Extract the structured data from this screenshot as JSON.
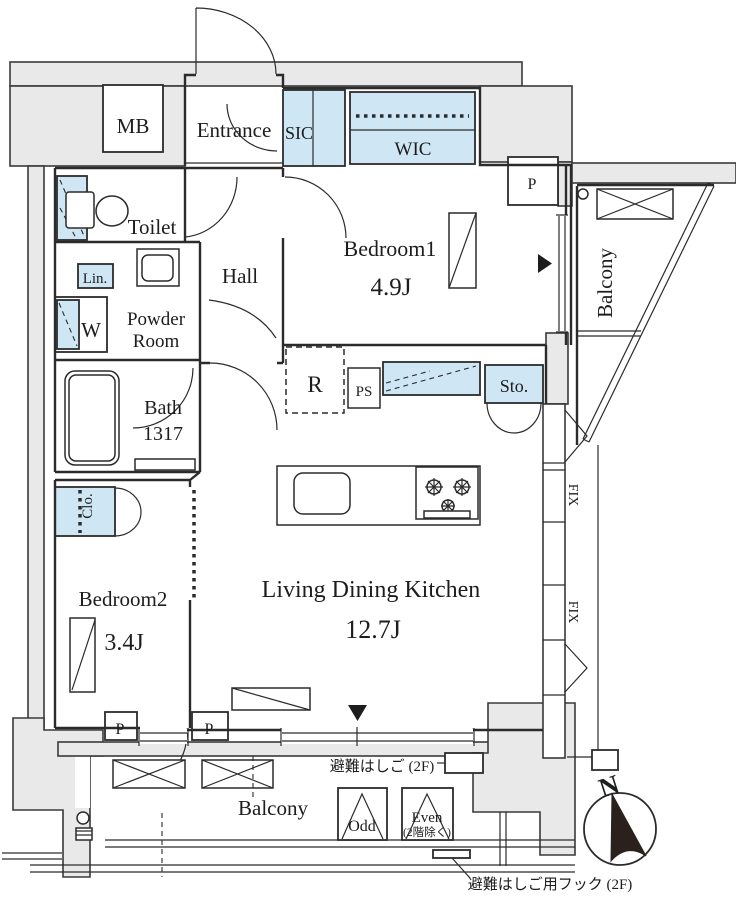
{
  "title": "apartment-floor-plan",
  "colors": {
    "fixture_blue": "#cfe7f5",
    "structure_gray": "#e9e9e9",
    "line": "#2b2b2b",
    "text": "#1d1d1d",
    "compass_black": "#2a211c"
  },
  "rooms": {
    "mb": "MB",
    "entrance": "Entrance",
    "sic": "SIC",
    "wic": "WIC",
    "toilet": "Toilet",
    "linen": "Lin.",
    "hall": "Hall",
    "powder_line1": "Powder",
    "powder_line2": "Room",
    "washer": "W",
    "bath_line1": "Bath",
    "bath_line2": "1317",
    "bedroom1": "Bedroom1",
    "bedroom1_size": "4.9J",
    "fridge": "R",
    "pipe_shaft": "PS",
    "storage": "Sto.",
    "ldk": "Living Dining Kitchen",
    "ldk_size": "12.7J",
    "bedroom2": "Bedroom2",
    "bedroom2_size": "3.4J",
    "closet": "Clo.",
    "balcony_right": "Balcony",
    "balcony_bottom": "Balcony",
    "fix1": "FIX",
    "fix2": "FIX",
    "p_top": "P",
    "p_bottom_left": "P",
    "p_bottom_right": "P"
  },
  "annotations": {
    "hatch_label": "避難はしご (2F)",
    "hook_label": "避難はしご用フック (2F)",
    "odd": "Odd",
    "even_line1": "Even",
    "even_line2": "(2階除く)",
    "north": "N"
  }
}
